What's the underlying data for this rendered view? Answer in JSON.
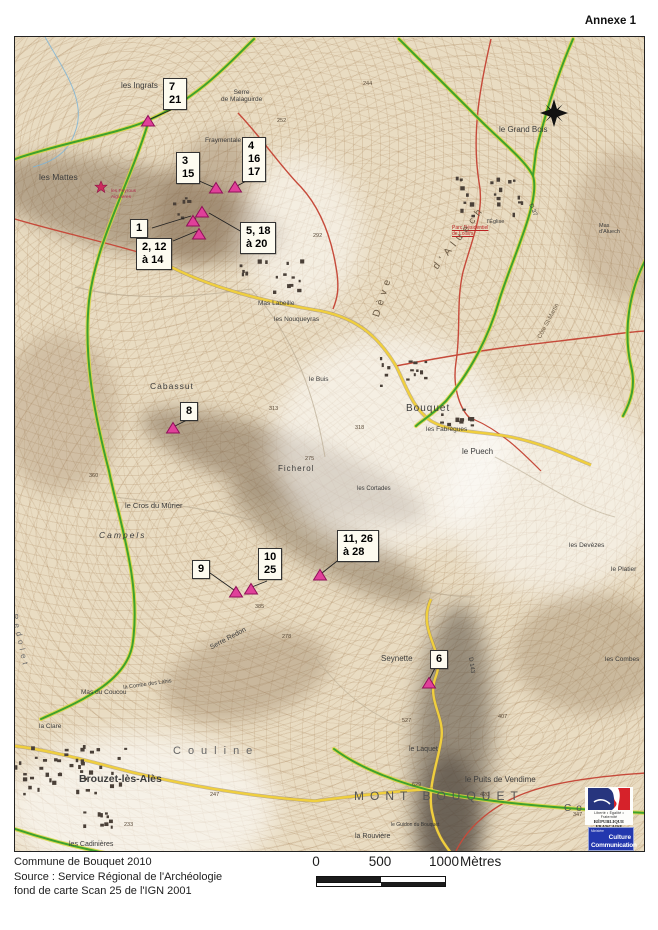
{
  "annexe_label": "Annexe 1",
  "caption": {
    "line1": "Commune de Bouquet 2010",
    "line2": "Source : Service Régional de l'Archéologie",
    "line3": "fond de carte Scan 25 de l'IGN 2001"
  },
  "scale_bar": {
    "tick0": "0",
    "tick500": "500",
    "tick1000": "1000",
    "unit": "Mètres"
  },
  "logos": {
    "republique": {
      "motto": "Liberté • Égalité • Fraternité",
      "name": "RÉPUBLIQUE FRANÇAISE"
    },
    "culture": {
      "ministere": "Ministère",
      "line1": "Culture",
      "line2": "Communication"
    }
  },
  "colors": {
    "map_bg": "#e9dcc2",
    "boundary_green": "#3fa22c",
    "boundary_glow": "#d8d53e",
    "road_yellow": "#f0cf3e",
    "road_red": "#c64a3a",
    "stream_blue": "#7ab4d8",
    "marker_fill": "#e0409a",
    "marker_stroke": "#8f1058",
    "label_bg": "#fdfbf0"
  },
  "site_labels": [
    {
      "text": "7\n21",
      "x": 162,
      "y": 77,
      "ax": 170,
      "ay": 109,
      "tx": 147,
      "ty": 119
    },
    {
      "text": "3\n15",
      "x": 175,
      "y": 151,
      "ax": 196,
      "ay": 179,
      "tx": 212,
      "ty": 186
    },
    {
      "text": "4\n16\n17",
      "x": 241,
      "y": 136,
      "ax": 247,
      "ay": 179,
      "tx": 236,
      "ty": 185
    },
    {
      "text": "1",
      "x": 129,
      "y": 218,
      "ax": 151,
      "ay": 227,
      "tx": 190,
      "ty": 215
    },
    {
      "text": "2, 12\nà 14",
      "x": 135,
      "y": 237,
      "ax": 172,
      "ay": 240,
      "tx": 196,
      "ty": 230
    },
    {
      "text": "5, 18\nà 20",
      "x": 239,
      "y": 221,
      "ax": 241,
      "ay": 231,
      "tx": 208,
      "ty": 212
    },
    {
      "text": "8",
      "x": 179,
      "y": 401,
      "ax": 186,
      "ay": 419,
      "tx": 174,
      "ty": 425
    },
    {
      "text": "9",
      "x": 191,
      "y": 559,
      "ax": 209,
      "ay": 572,
      "tx": 233,
      "ty": 589
    },
    {
      "text": "10\n25",
      "x": 257,
      "y": 547,
      "ax": 266,
      "ay": 580,
      "tx": 251,
      "ty": 586
    },
    {
      "text": "11, 26\nà 28",
      "x": 336,
      "y": 529,
      "ax": 340,
      "ay": 557,
      "tx": 321,
      "ty": 572
    },
    {
      "text": "6",
      "x": 429,
      "y": 649,
      "ax": 434,
      "ay": 667,
      "tx": 428,
      "ty": 679
    }
  ],
  "markers": [
    {
      "x": 147,
      "y": 120
    },
    {
      "x": 215,
      "y": 187
    },
    {
      "x": 234,
      "y": 186
    },
    {
      "x": 201,
      "y": 211
    },
    {
      "x": 192,
      "y": 220
    },
    {
      "x": 198,
      "y": 233
    },
    {
      "x": 172,
      "y": 427
    },
    {
      "x": 235,
      "y": 591
    },
    {
      "x": 250,
      "y": 588
    },
    {
      "x": 319,
      "y": 574
    },
    {
      "x": 428,
      "y": 682
    }
  ],
  "red_star": {
    "x": 96,
    "y": 178,
    "label": "les Peyrous\nAiguières"
  },
  "place_names": [
    {
      "text": "les Ingrats",
      "x": 106,
      "y": 44,
      "size": 8
    },
    {
      "text": "Serre\nde Malaguirde",
      "x": 206,
      "y": 52,
      "size": 6.5,
      "align": "center"
    },
    {
      "text": "Fraymentale",
      "x": 190,
      "y": 100,
      "size": 6.5
    },
    {
      "text": "les Mattes",
      "x": 24,
      "y": 136,
      "size": 8.5
    },
    {
      "text": "le Grand Bois",
      "x": 484,
      "y": 88,
      "size": 8
    },
    {
      "text": "Mas\nd'Aluech",
      "x": 584,
      "y": 186,
      "size": 5.5
    },
    {
      "text": "l'Église",
      "x": 472,
      "y": 182,
      "size": 5.5
    },
    {
      "text": "Parc Résidentiel\nde Loisirs",
      "x": 437,
      "y": 189,
      "size": 5,
      "color": "#bb2222",
      "underline": true
    },
    {
      "text": "Mas Labeille",
      "x": 243,
      "y": 263,
      "size": 6.5
    },
    {
      "text": "les Nouqueyras",
      "x": 259,
      "y": 279,
      "size": 6.5
    },
    {
      "text": "le Buis",
      "x": 294,
      "y": 339,
      "size": 6.5
    },
    {
      "text": "Cabassut",
      "x": 135,
      "y": 345,
      "size": 8.5,
      "ls": 1
    },
    {
      "text": "Bouquet",
      "x": 391,
      "y": 366,
      "size": 10,
      "ls": 1
    },
    {
      "text": "les Fabrègues",
      "x": 411,
      "y": 389,
      "size": 6.5
    },
    {
      "text": "le Puech",
      "x": 447,
      "y": 410,
      "size": 8
    },
    {
      "text": "les Cortades",
      "x": 342,
      "y": 449,
      "size": 6
    },
    {
      "text": "Ficherol",
      "x": 263,
      "y": 427,
      "size": 8,
      "ls": 1
    },
    {
      "text": "le Cros du Mûrier",
      "x": 110,
      "y": 465,
      "size": 7.5
    },
    {
      "text": "Campels",
      "x": 84,
      "y": 494,
      "size": 8.5,
      "ls": 2,
      "italic": true
    },
    {
      "text": "les Devèzes",
      "x": 554,
      "y": 505,
      "size": 6.5
    },
    {
      "text": "le Platier",
      "x": 596,
      "y": 529,
      "size": 6.5
    },
    {
      "text": "Serre Redon",
      "x": 194,
      "y": 608,
      "size": 7,
      "rot": -28
    },
    {
      "text": "la Combe des Lahis",
      "x": 108,
      "y": 648,
      "size": 5.5,
      "rot": -8
    },
    {
      "text": "Mas du Coucou",
      "x": 66,
      "y": 652,
      "size": 6.5
    },
    {
      "text": "la Clare",
      "x": 24,
      "y": 686,
      "size": 6.5
    },
    {
      "text": "les Combes",
      "x": 590,
      "y": 619,
      "size": 6.5
    },
    {
      "text": "Seynette",
      "x": 366,
      "y": 617,
      "size": 8
    },
    {
      "text": "le Laquet",
      "x": 394,
      "y": 709,
      "size": 7
    },
    {
      "text": "Couline",
      "x": 158,
      "y": 708,
      "size": 11,
      "ls": 7,
      "color": "#666666"
    },
    {
      "text": "Brouzet-lès-Alès",
      "x": 64,
      "y": 736,
      "size": 10.5,
      "bold": true
    },
    {
      "text": "MONT BOUQUET",
      "x": 339,
      "y": 753,
      "size": 12,
      "ls": 6,
      "color": "#555555"
    },
    {
      "text": "le Puits de Vendime",
      "x": 450,
      "y": 738,
      "size": 8
    },
    {
      "text": "Combeil",
      "x": 549,
      "y": 766,
      "size": 10,
      "ls": 5,
      "color": "#555555"
    },
    {
      "text": "la Rouvière",
      "x": 340,
      "y": 796,
      "size": 7
    },
    {
      "text": "la Bouvière",
      "x": 350,
      "y": 818,
      "size": 6.5
    },
    {
      "text": "le Guidon du Bouquet",
      "x": 376,
      "y": 786,
      "size": 5,
      "color": "#333333"
    },
    {
      "text": "les Cadinières",
      "x": 54,
      "y": 804,
      "size": 7
    },
    {
      "text": "la Bègude",
      "x": 80,
      "y": 834,
      "size": 6.5
    },
    {
      "text": "Dève",
      "x": 356,
      "y": 278,
      "size": 10,
      "rot": -72,
      "ls": 5,
      "color": "#6b5a44"
    },
    {
      "text": "d'Aluech",
      "x": 416,
      "y": 228,
      "size": 10,
      "rot": -52,
      "ls": 5,
      "color": "#6b5a44"
    },
    {
      "text": "Côte St-Martin",
      "x": 522,
      "y": 300,
      "size": 6,
      "rot": -62,
      "color": "#6b5a44"
    },
    {
      "text": "Redolet",
      "x": 4,
      "y": 576,
      "size": 8,
      "rot": 78,
      "ls": 4,
      "color": "#6b6b6b"
    },
    {
      "text": "D 37",
      "x": 518,
      "y": 166,
      "size": 6,
      "rot": 68
    },
    {
      "text": "D 143",
      "x": 458,
      "y": 620,
      "size": 6,
      "rot": 82
    }
  ],
  "spot_heights": [
    {
      "v": "244",
      "x": 348,
      "y": 44
    },
    {
      "v": "252",
      "x": 262,
      "y": 81
    },
    {
      "v": "230",
      "x": 229,
      "y": 111
    },
    {
      "v": "292",
      "x": 298,
      "y": 196
    },
    {
      "v": "318",
      "x": 340,
      "y": 388
    },
    {
      "v": "313",
      "x": 254,
      "y": 369
    },
    {
      "v": "275",
      "x": 290,
      "y": 419
    },
    {
      "v": "360",
      "x": 74,
      "y": 436
    },
    {
      "v": "385",
      "x": 240,
      "y": 567
    },
    {
      "v": "278",
      "x": 267,
      "y": 597
    },
    {
      "v": "527",
      "x": 387,
      "y": 681
    },
    {
      "v": "407",
      "x": 483,
      "y": 677
    },
    {
      "v": "420",
      "x": 465,
      "y": 755
    },
    {
      "v": "629",
      "x": 397,
      "y": 745
    },
    {
      "v": "347",
      "x": 558,
      "y": 775
    },
    {
      "v": "247",
      "x": 195,
      "y": 755
    },
    {
      "v": "233",
      "x": 109,
      "y": 785
    }
  ],
  "villages": [
    {
      "x": 14,
      "y": 744,
      "w": 110,
      "h": 48,
      "n": 42
    },
    {
      "x": 376,
      "y": 356,
      "w": 48,
      "h": 28,
      "n": 14
    },
    {
      "x": 436,
      "y": 406,
      "w": 36,
      "h": 20,
      "n": 10
    },
    {
      "x": 238,
      "y": 258,
      "w": 64,
      "h": 32,
      "n": 16
    },
    {
      "x": 452,
      "y": 174,
      "w": 68,
      "h": 40,
      "n": 22
    },
    {
      "x": 46,
      "y": 808,
      "w": 64,
      "h": 22,
      "n": 10
    },
    {
      "x": 172,
      "y": 196,
      "w": 30,
      "h": 22,
      "n": 8
    }
  ]
}
